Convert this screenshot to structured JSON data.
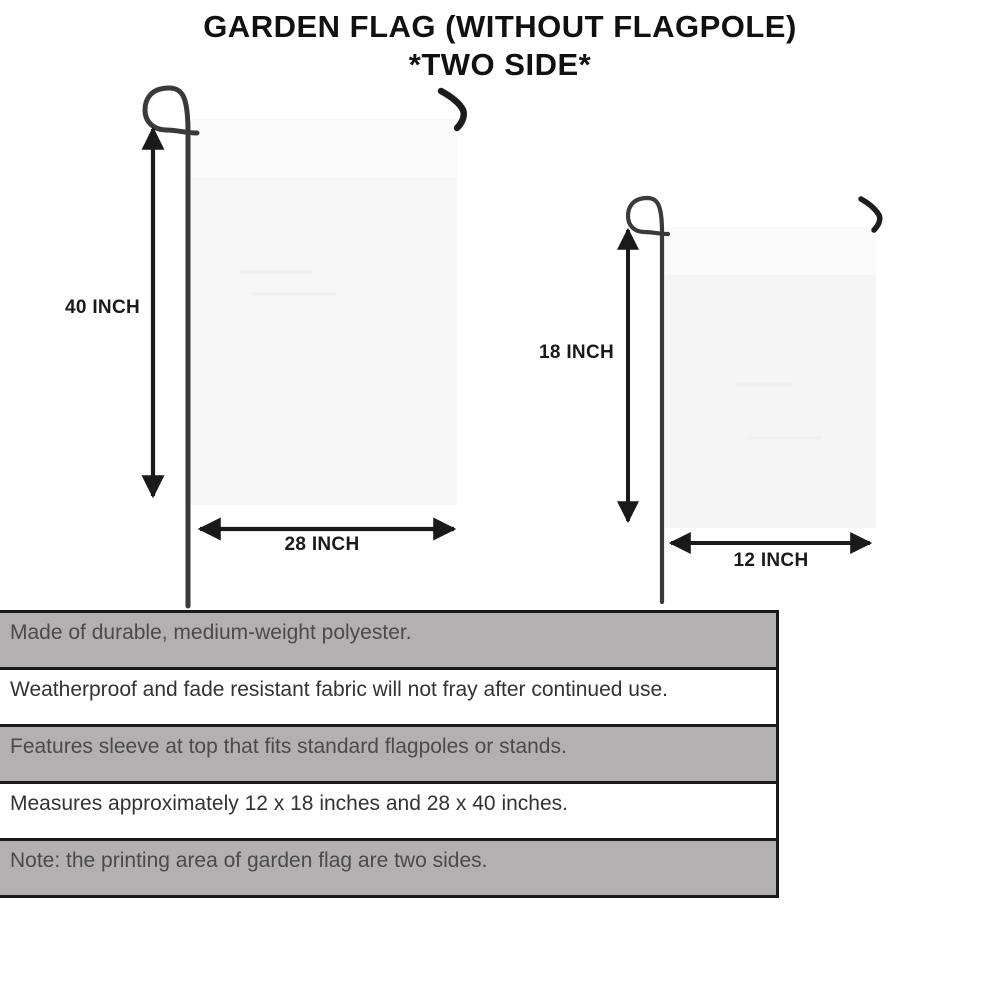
{
  "title": {
    "line1": "GARDEN FLAG (WITHOUT FLAGPOLE)",
    "line2": "*TWO SIDE*"
  },
  "diagram": {
    "large_flag": {
      "height_label": "40 INCH",
      "width_label": "28 INCH"
    },
    "small_flag": {
      "height_label": "18 INCH",
      "width_label": "12 INCH"
    }
  },
  "features": {
    "rows": [
      {
        "text": "Made of durable, medium-weight polyester.",
        "shaded": true
      },
      {
        "text": "Weatherproof and fade resistant fabric will not fray after continued use.",
        "shaded": false
      },
      {
        "text": "Features sleeve at top that fits standard flagpoles or stands.",
        "shaded": true
      },
      {
        "text": "Measures approximately 12 x 18 inches and 28 x 40 inches.",
        "shaded": false
      },
      {
        "text": "Note: the printing area of garden flag are two sides.",
        "shaded": true
      }
    ]
  },
  "colors": {
    "row_shaded_bg": "#b3b0b1",
    "table_border": "#1a1a1a",
    "flag_fill": "#f7f6f6",
    "pole": "#3a3a3a",
    "arrow": "#1a1a1a",
    "title_text": "#111111"
  }
}
